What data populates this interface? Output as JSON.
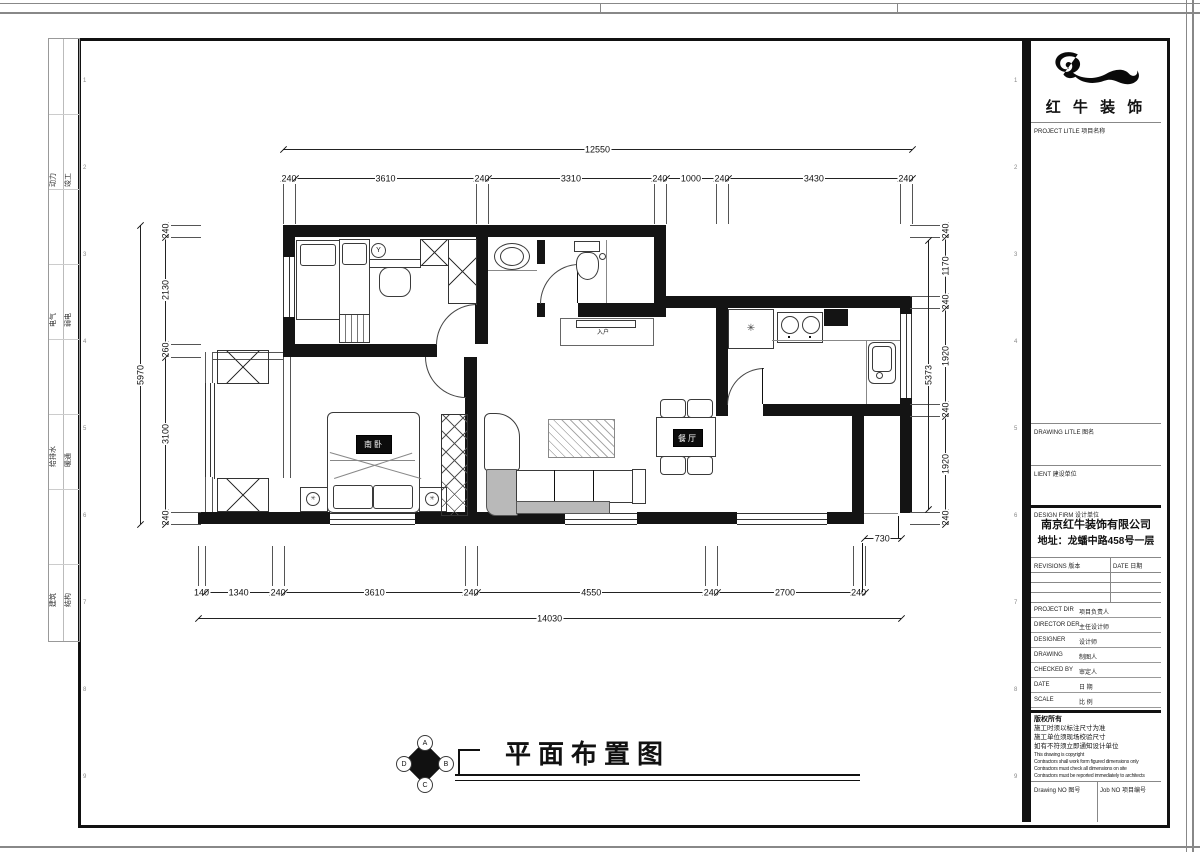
{
  "sheet": {
    "side_strip": {
      "pairs": [
        [
          "动力",
          "竣工"
        ],
        [
          "电气",
          "弱电"
        ],
        [
          "给排水",
          "暖通"
        ],
        [
          "建筑",
          "结构"
        ]
      ]
    },
    "grid_refs": [
      "1",
      "2",
      "3",
      "4",
      "5",
      "6",
      "7",
      "8",
      "9"
    ]
  },
  "title_block": {
    "logo_text": "红 牛 装 饰",
    "project_title_label": "PROJECT LITLE  项目名称",
    "drawing_title_label": "DRAWING LITLE  图名",
    "client_label": "LIENT  建设单位",
    "design_firm_label": "DESIGN FIRM  设计单位",
    "company_name": "南京红牛装饰有限公司",
    "company_address": "地址：龙蟠中路458号一层",
    "revisions_label": "REVISIONS  版本",
    "revisions_date_label": "DATE  日期",
    "staff_rows": [
      {
        "en": "PROJECT DIR",
        "cn": "项目负责人"
      },
      {
        "en": "DIRECTOR DER",
        "cn": "主任设计师"
      },
      {
        "en": "DESIGNER",
        "cn": "设计师"
      },
      {
        "en": "DRAWING",
        "cn": "制图人"
      },
      {
        "en": "CHECKED BY",
        "cn": "审定人"
      },
      {
        "en": "DATE",
        "cn": "日  期"
      },
      {
        "en": "SCALE",
        "cn": "比  例"
      }
    ],
    "copyright_cn": [
      "版权所有",
      "施工时须以标注尺寸为准",
      "施工单位须现场校验尺寸",
      "如有不符须立即通知设计单位"
    ],
    "copyright_en": [
      "This drawing is copyright",
      "Contractors shall work form figured dimensions only",
      "Contractors must check all dimensions on site",
      "Contractors must be reported immediately to architects"
    ],
    "drawing_no_label": "Drawing NO  图号",
    "job_no_label": "Job NO  项目编号"
  },
  "plan": {
    "title": "平面布置图",
    "compass": {
      "top": "A",
      "right": "B",
      "bottom": "C",
      "left": "D"
    },
    "labels": {
      "south_bedroom": "南卧",
      "dining": "餐厅",
      "entry": "入户"
    },
    "icons": {
      "fridge_glyph": "✳",
      "stool_glyph": "Y",
      "lamp_glyph": "✳"
    },
    "dims": {
      "top_overall": [
        12550
      ],
      "top": [
        240,
        3610,
        240,
        3310,
        240,
        1000,
        240,
        3430,
        240
      ],
      "left_overall": [
        5970
      ],
      "left": [
        240,
        2130,
        260,
        3100,
        240
      ],
      "right": [
        240,
        1170,
        240,
        1920,
        240,
        1920,
        240
      ],
      "right_inner": [
        5373
      ],
      "bottom": [
        140,
        1340,
        240,
        3610,
        240,
        4550,
        240,
        2700,
        240
      ],
      "bottom_overall": [
        14030
      ],
      "step": [
        730
      ]
    }
  }
}
